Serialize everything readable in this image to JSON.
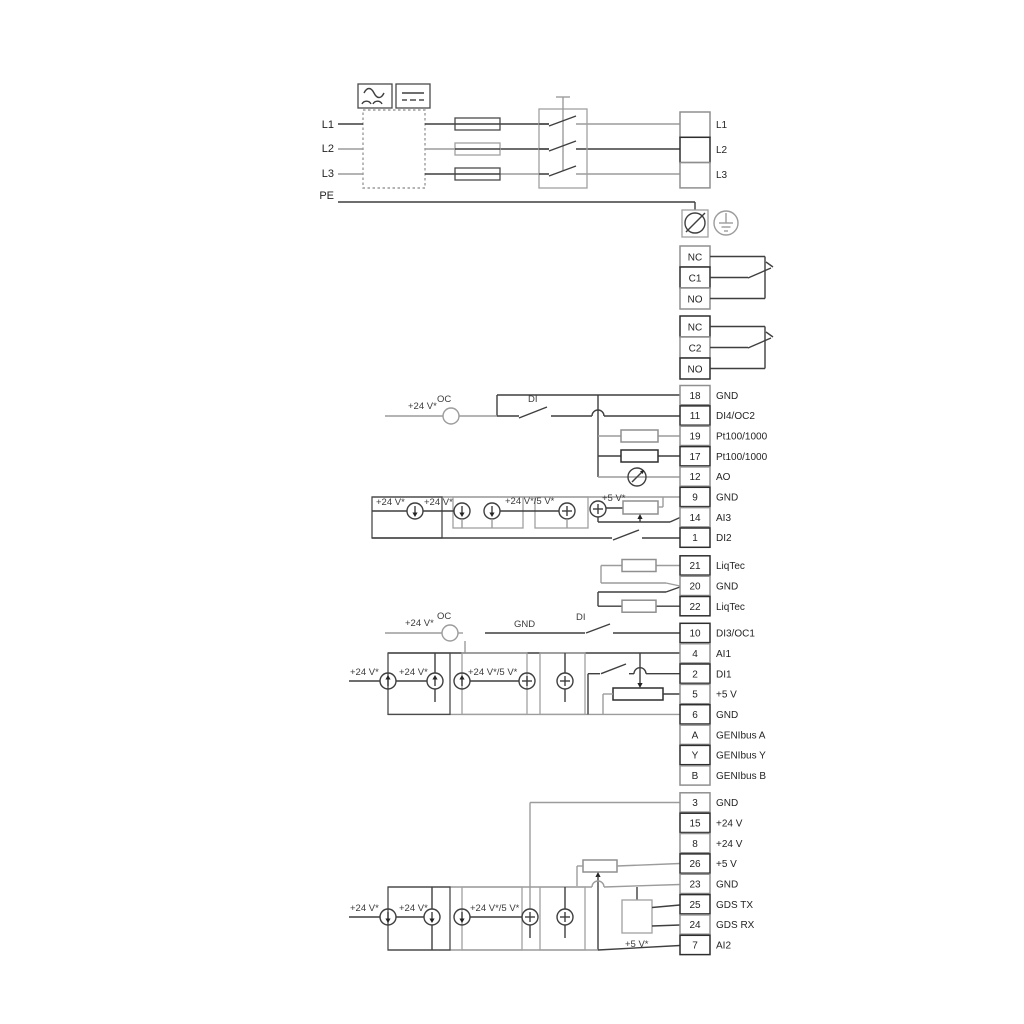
{
  "mains": {
    "l1": "L1",
    "l2": "L2",
    "l3": "L3",
    "pe": "PE"
  },
  "right_terminals": {
    "l1": "L1",
    "l2": "L2",
    "l3": "L3"
  },
  "relay1": {
    "nc": "NC",
    "c": "C1",
    "no": "NO"
  },
  "relay2": {
    "nc": "NC",
    "c": "C2",
    "no": "NO"
  },
  "strips": {
    "a": [
      {
        "num": "18",
        "label": "GND"
      },
      {
        "num": "11",
        "label": "DI4/OC2"
      },
      {
        "num": "19",
        "label": "Pt100/1000"
      },
      {
        "num": "17",
        "label": "Pt100/1000"
      },
      {
        "num": "12",
        "label": "AO"
      },
      {
        "num": "9",
        "label": "GND"
      },
      {
        "num": "14",
        "label": "AI3"
      },
      {
        "num": "1",
        "label": "DI2"
      }
    ],
    "b": [
      {
        "num": "21",
        "label": "LiqTec"
      },
      {
        "num": "20",
        "label": "GND"
      },
      {
        "num": "22",
        "label": "LiqTec"
      }
    ],
    "c": [
      {
        "num": "10",
        "label": "DI3/OC1"
      },
      {
        "num": "4",
        "label": "AI1"
      },
      {
        "num": "2",
        "label": "DI1"
      },
      {
        "num": "5",
        "label": "+5 V"
      },
      {
        "num": "6",
        "label": "GND"
      },
      {
        "num": "A",
        "label": "GENIbus A"
      },
      {
        "num": "Y",
        "label": "GENIbus Y"
      },
      {
        "num": "B",
        "label": "GENIbus B"
      }
    ],
    "d": [
      {
        "num": "3",
        "label": "GND"
      },
      {
        "num": "15",
        "label": "+24 V"
      },
      {
        "num": "8",
        "label": "+24 V"
      },
      {
        "num": "26",
        "label": "+5 V"
      },
      {
        "num": "23",
        "label": "GND"
      },
      {
        "num": "25",
        "label": "GDS TX"
      },
      {
        "num": "24",
        "label": "GDS RX"
      },
      {
        "num": "7",
        "label": "AI2"
      }
    ]
  },
  "wire_labels": {
    "p24": "+24 V*",
    "p24_5": "+24 V*/5 V*",
    "p5": "+5 V*",
    "oc": "OC",
    "di": "DI",
    "gnd": "GND"
  },
  "colors": {
    "wire_dark": "#3f3f3f",
    "wire_gray": "#9c9c9c",
    "background": "#ffffff"
  }
}
